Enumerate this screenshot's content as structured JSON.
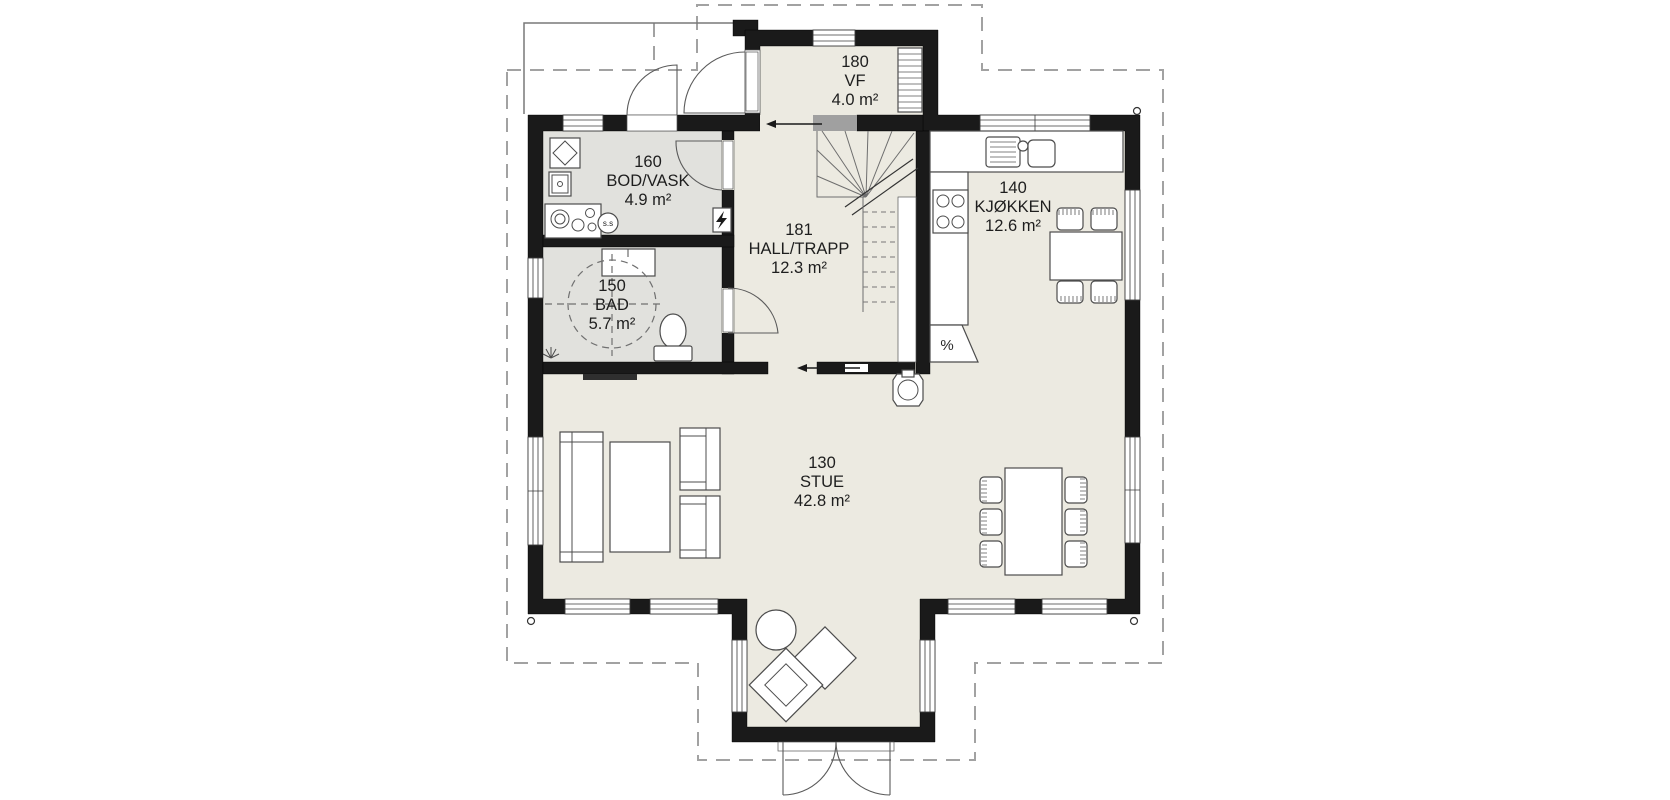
{
  "document": {
    "type": "architectural-floor-plan",
    "description": "Single family house, main floor plan"
  },
  "colors": {
    "wall": "#1a1a1a",
    "floor": "#eceae1",
    "wet_room_floor": "#e1e1dd",
    "furniture": "#ffffff",
    "overhang_dash": "#a2a2a2",
    "background": "#ffffff"
  },
  "rooms": [
    {
      "number": "180",
      "name": "VF",
      "area": "4.0 m²"
    },
    {
      "number": "160",
      "name": "BOD/VASK",
      "area": "4.9 m²"
    },
    {
      "number": "181",
      "name": "HALL/TRAPP",
      "area": "12.3 m²"
    },
    {
      "number": "140",
      "name": "KJØKKEN",
      "area": "12.6 m²"
    },
    {
      "number": "150",
      "name": "BAD",
      "area": "5.7 m²"
    },
    {
      "number": "130",
      "name": "STUE",
      "area": "42.8 m²"
    }
  ],
  "annotations": {
    "dishwasher_symbol": "%",
    "floor_drain_label": "s.s"
  }
}
